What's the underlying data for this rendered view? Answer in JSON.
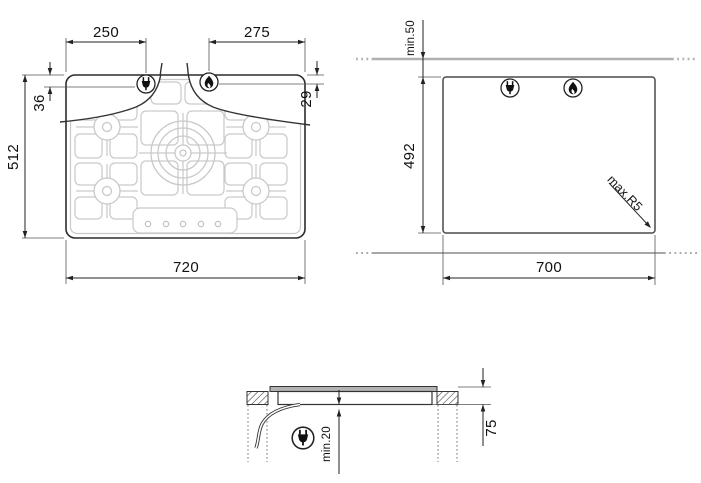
{
  "drawing": {
    "type": "gas-hob-installation-diagram",
    "views": {
      "hob_top": {
        "plug_offset": "250",
        "burner_offset": "275",
        "plug_inset": "36",
        "burner_inset": "29",
        "depth": "512",
        "width": "720"
      },
      "cutout": {
        "min_wall_clearance": "min.50",
        "depth": "492",
        "width": "700",
        "max_corner_radius": "max.R5"
      },
      "section": {
        "min_clearance_below": "min.20",
        "built_in_depth": "75"
      }
    },
    "icons": [
      "electric-plug-icon",
      "gas-flame-icon"
    ],
    "colors": {
      "line": "#222222",
      "grid": "#c9c9c9",
      "wall_line": "#b0b0b0",
      "counter_line": "#8a8a8a",
      "slab_fill": "#b3b3b3"
    }
  }
}
